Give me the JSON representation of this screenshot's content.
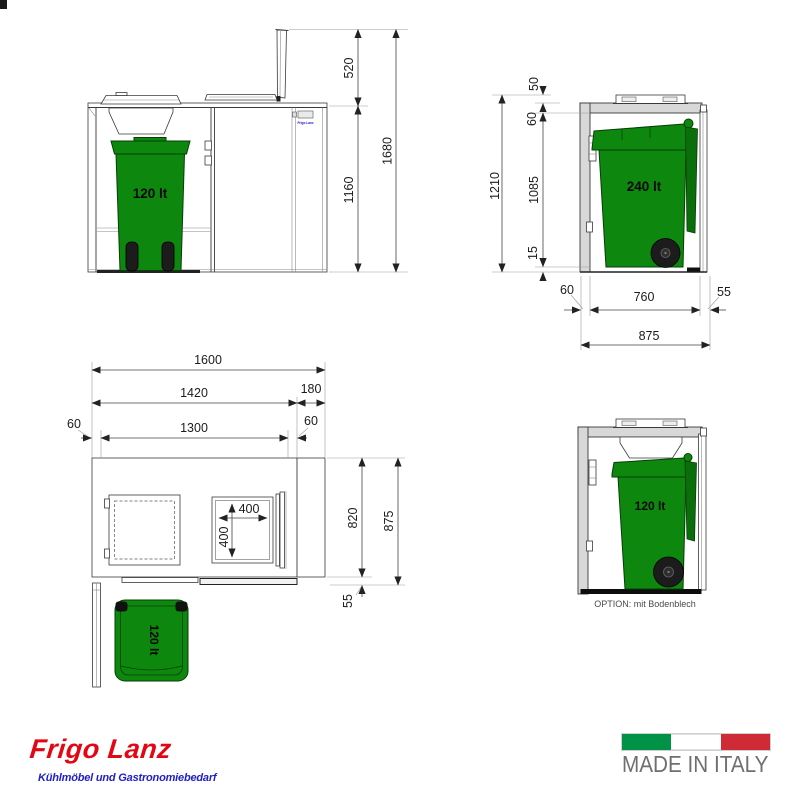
{
  "views": {
    "front": {
      "bin_label": "120 lt",
      "panel_text": "Frigo Lanz",
      "dim_lid_open": "520",
      "dim_body_height": "1160",
      "dim_total_height": "1680"
    },
    "side240": {
      "bin_label": "240 lt",
      "dim_handle_height": "50",
      "dim_roof_thickness": "60",
      "dim_total_height": "1210",
      "dim_interior_height": "1085",
      "dim_base_height": "15",
      "dim_wall_thickness": "60",
      "dim_interior_width": "760",
      "dim_right_gap": "55",
      "dim_total_width": "875"
    },
    "plan": {
      "bin_label": "120 lt",
      "dim_total_width": "1600",
      "dim_body_width": "1420",
      "dim_unit_depth": "180",
      "dim_wall_left": "60",
      "dim_interior_width": "1300",
      "dim_wall_right": "60",
      "dim_opening_width": "400",
      "dim_opening_depth": "400",
      "dim_body_depth": "820",
      "dim_total_depth": "875",
      "dim_door_offset": "55"
    },
    "side120": {
      "bin_label": "120 lt",
      "caption": "OPTION: mit Bodenblech"
    }
  },
  "branding": {
    "logo_title": "Frigo Lanz",
    "logo_subtitle": "Kühlmöbel und Gastronomiebedarf",
    "made_in_italy": "MADE IN ITALY"
  },
  "colors": {
    "bin_green": "#0e870e",
    "bin_green_dark": "#0a6e0a",
    "wall_grey": "#d8d8d8",
    "logo_red": "#e30613",
    "logo_blue": "#2020c8",
    "flag_green": "#009246",
    "flag_white": "#ffffff",
    "flag_red": "#ce2b37",
    "made_in_grey": "#6f6f6f"
  }
}
